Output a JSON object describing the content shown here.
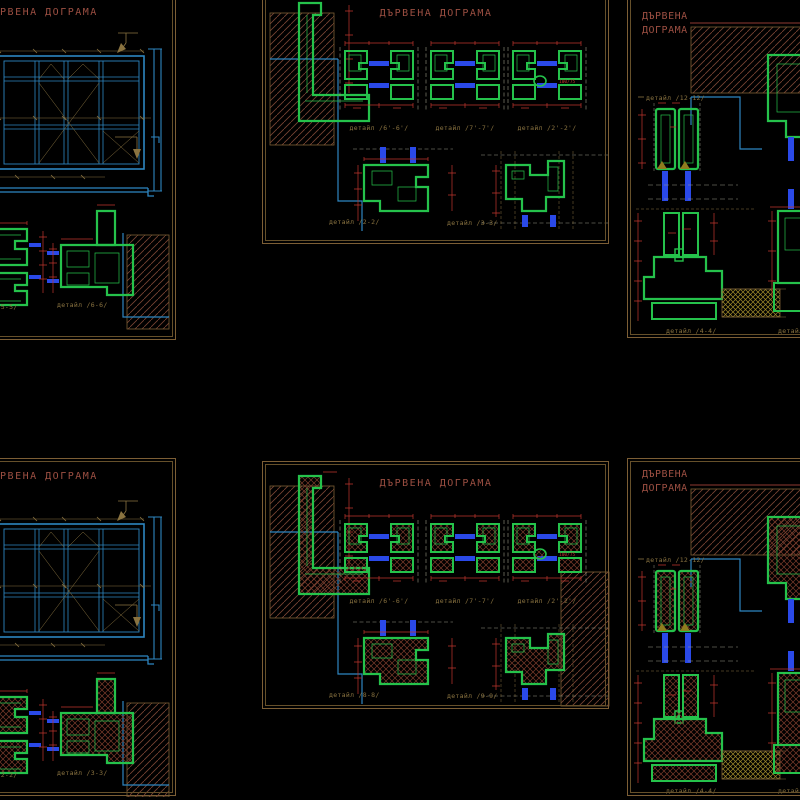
{
  "sheet": {
    "background": "#000000",
    "border_color": "#7c5e35",
    "title_color": "#9c4f42"
  },
  "layers": {
    "profile_green": "#25c24b",
    "dimension_red": "#c0362e",
    "glazing_blue": "#2a49e8",
    "elevation_cyan": "#2e86c1",
    "wall_hatch_brown": "#7a4434",
    "annotation_tan": "#8a7340",
    "sill_hatch_olive": "#a08a2a"
  },
  "panels": {
    "top_left": {
      "title": "ДЪРВЕНА ДОГРАМА",
      "detail_labels": {
        "left": "детайл /5-5/",
        "right": "детайл /6-6/"
      }
    },
    "top_middle": {
      "title": "ДЪРВЕНА ДОГРАМА",
      "detail_labels": {
        "d1": "детайл /6'-6'/",
        "d2": "детайл /7'-7'/",
        "d3": "детайл /2'-2'/",
        "d4": "детайл /2-2/",
        "d5": "детайл /3-3/"
      },
      "notes": {
        "d3_size": "100/75"
      }
    },
    "top_right": {
      "title_line1": "ДЪРВЕНА",
      "title_line2": "ДОГРАМА",
      "detail_labels": {
        "d1": "детайл /12-12/",
        "d2": "детайл /4-4/",
        "d3": "детайл"
      }
    },
    "bottom_left": {
      "title": "ДЪРВЕНА ДОГРАМА",
      "detail_labels": {
        "left": "детайл /2-2/",
        "right": "детайл /3-3/"
      }
    },
    "bottom_middle": {
      "title": "ДЪРВЕНА ДОГРАМА",
      "detail_labels": {
        "d1": "детайл /6'-6'/",
        "d2": "детайл /7'-7'/",
        "d3": "детайл /2'-2'/",
        "d4": "детайл /8-8/",
        "d5": "детайл /9-9/"
      },
      "notes": {
        "d3_size": "100/75"
      }
    },
    "bottom_right": {
      "title_line1": "ДЪРВЕНА",
      "title_line2": "ДОГРАМА",
      "detail_labels": {
        "d1": "детайл /12-12/",
        "d2": "детайл /4-4/",
        "d3": "детайл"
      }
    }
  }
}
